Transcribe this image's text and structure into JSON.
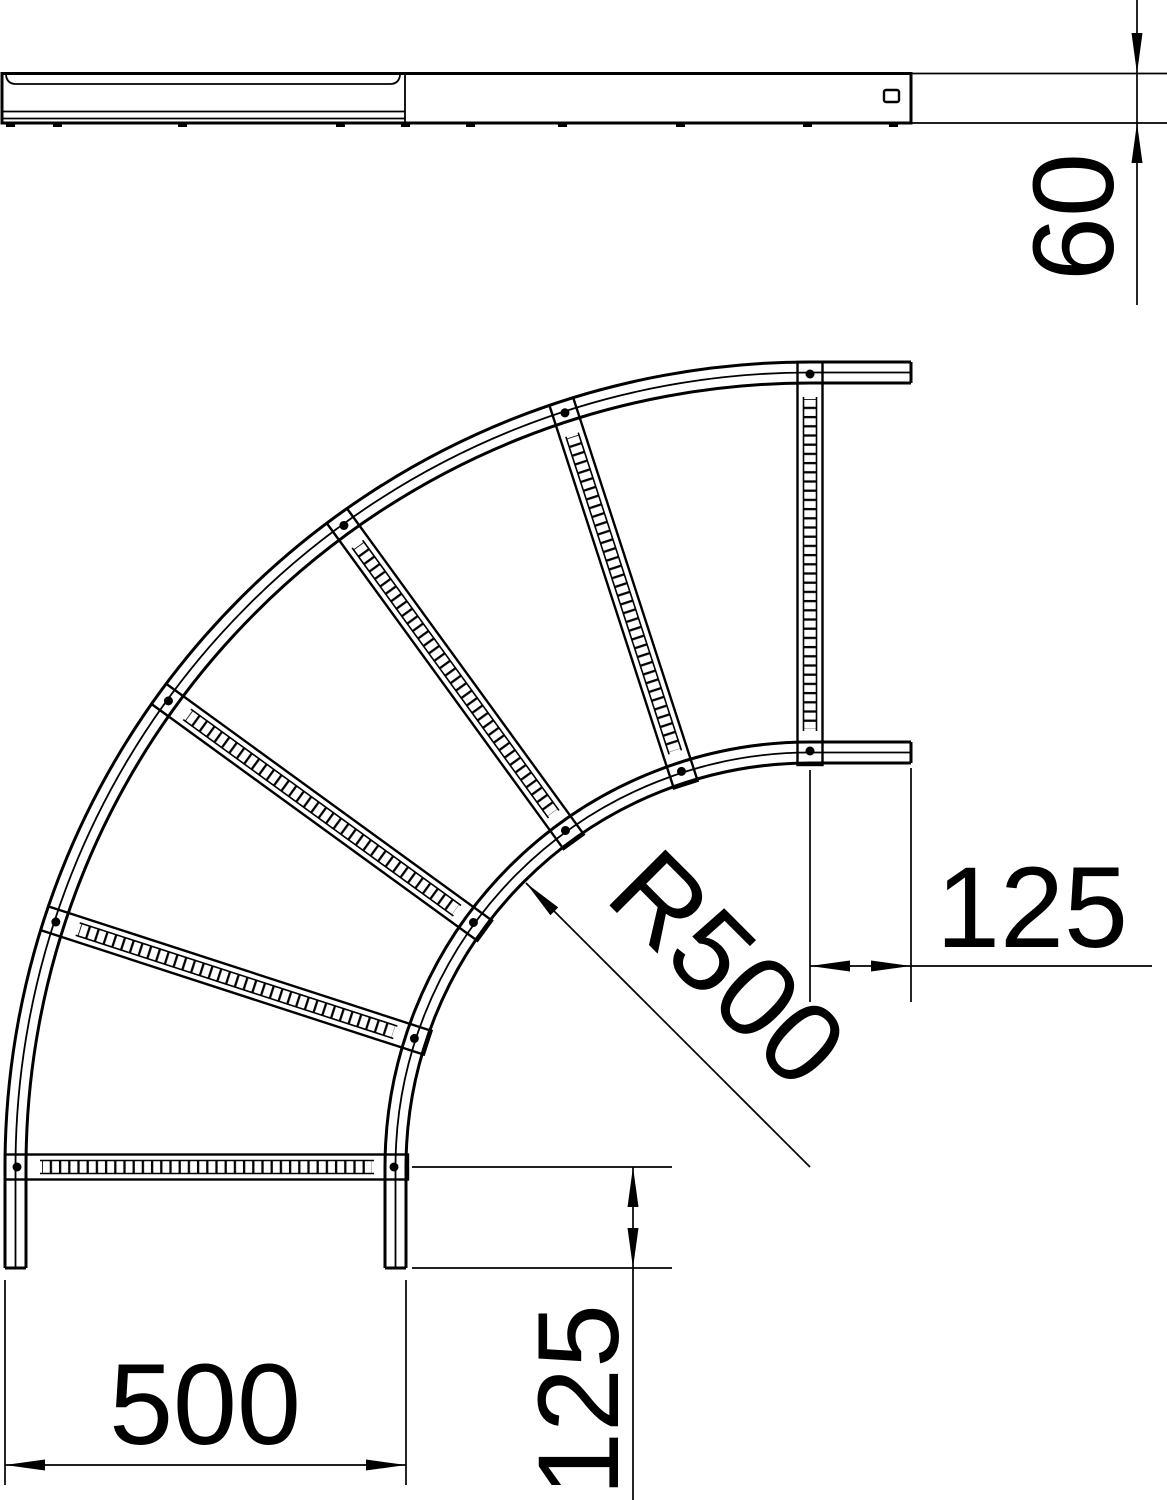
{
  "dimensions": {
    "side_height": "60",
    "radius": "R500",
    "width": "500",
    "tangent_right": "125",
    "tangent_bottom": "125"
  },
  "colors": {
    "line": "#000000",
    "background": "#ffffff"
  }
}
